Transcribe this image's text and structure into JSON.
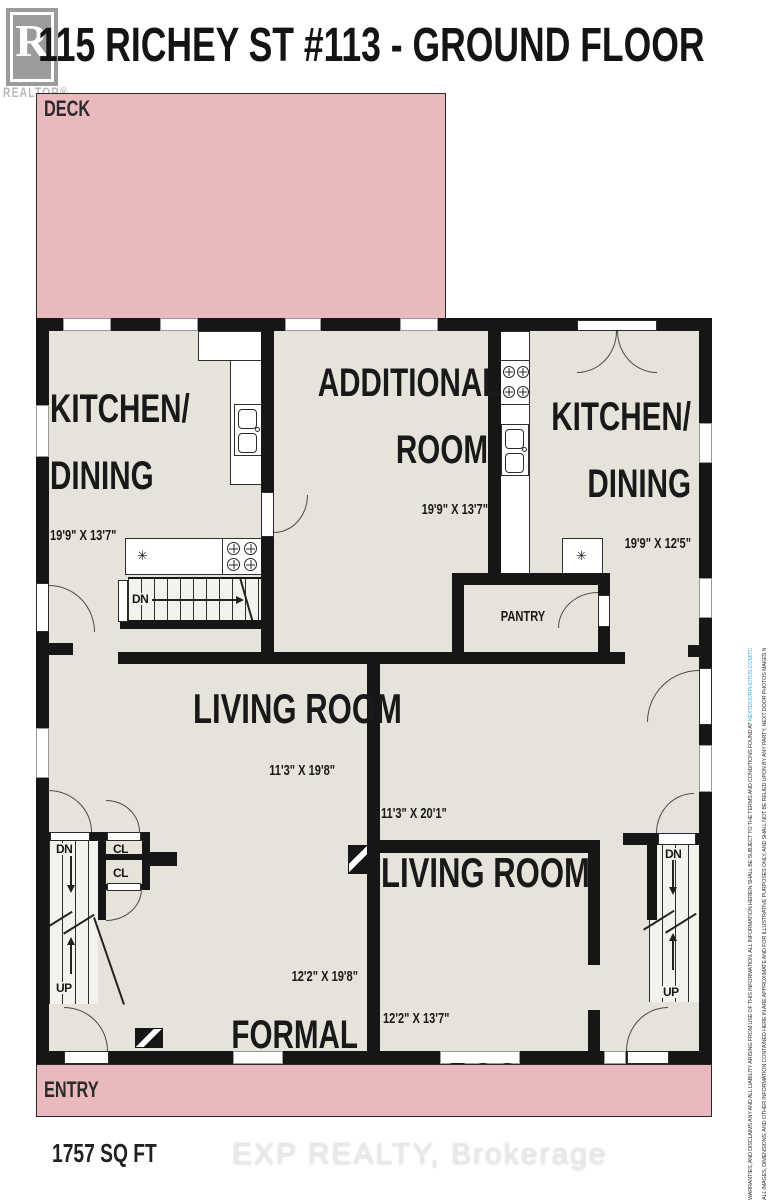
{
  "header": {
    "title": "115 RICHEY ST #113 - GROUND FLOOR",
    "logo_letter": "R",
    "logo_brand": "REALTOR®"
  },
  "plan": {
    "deck": "DECK",
    "entry": "ENTRY",
    "pantry": "PANTRY",
    "labels": {
      "dn": "DN",
      "up": "UP",
      "cl": "CL"
    },
    "rooms": {
      "kitchen_left": {
        "line1": "KITCHEN/",
        "line2": "DINING",
        "dims": "19'9\" X 13'7\""
      },
      "additional": {
        "line1": "ADDITIONAL",
        "line2": "ROOM",
        "dims": "19'9\" X 13'7\""
      },
      "kitchen_right": {
        "line1": "KITCHEN/",
        "line2": "DINING",
        "dims": "19'9\" X 12'5\""
      },
      "living_left": {
        "line1": "LIVING ROOM",
        "dims": "11'3\" X 19'8\""
      },
      "living_right": {
        "line1": "LIVING ROOM",
        "dims": "11'3\" X 20'1\""
      },
      "formal_dining": {
        "line1": "FORMAL",
        "line2": "DINING",
        "dims": "12'2\" X 19'8\""
      },
      "bedroom": {
        "line1": "BEDROOM",
        "dims": "12'2\" X 13'7\""
      }
    },
    "icons": {
      "appliance_star": "✳"
    }
  },
  "footer": {
    "area": "1757 SQ FT",
    "watermark": "EXP REALTY, Brokerage"
  },
  "disclaimer": {
    "line1": "ALL IMAGES, DIMENSIONS, AND OTHER INFORMATION CONTAINED HERE IN ARE APPROXIMATE AND FOR ILLUSTRATIVE PURPOSES ONLY, AND SHALL NOT BE RELIED UPON BY ANY PARTY. NEXT DOOR PHOTOS MAKES NO REPRESENTATIONS OR",
    "line2": "WARRANTIES, AND DISCLAIMS ANY AND ALL LIABILITY ARISING FROM USE OF THIS INFORMATION. ALL INFORMATION HEREIN SHALL BE SUBJECT TO THE TERMS AND CONDITIONS FOUND AT ",
    "url": "NEXTDOORPHOTOS.COM/TC"
  },
  "colors": {
    "pink": "#eab9bd",
    "floor": "#e6e4da",
    "wall": "#161616",
    "url_blue": "#3fa9e0",
    "logo_gray": "#9b9b9b"
  }
}
